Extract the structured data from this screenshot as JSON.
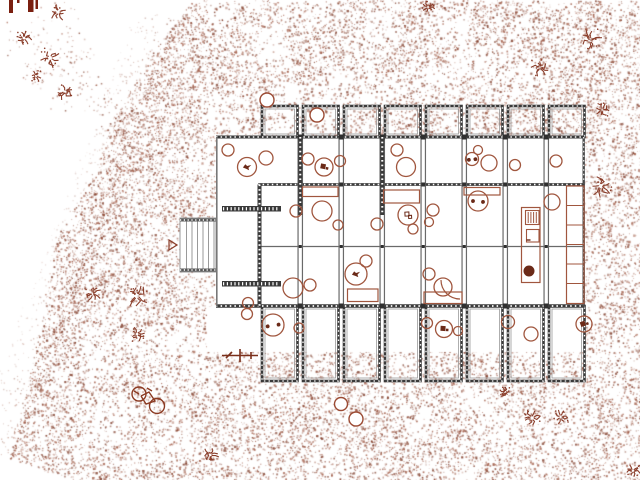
{
  "meta": {
    "width": 640,
    "height": 480,
    "kind": "architectural-site-plan"
  },
  "palette": {
    "paper": "#ffffff",
    "stipple_light": "#a05a45",
    "stipple_dark": "#7e3b28",
    "wall_dark": "#3a3a3a",
    "wall_mid": "#585858",
    "wall_light": "#9a9a9a",
    "furniture": "#a0563e",
    "furniture_dark": "#6b2a18",
    "maroon": "#7a1f10",
    "ground_symbol": "#8a3d2a"
  },
  "site": {
    "stipple_polygon": [
      [
        193,
        0
      ],
      [
        640,
        0
      ],
      [
        640,
        480
      ],
      [
        70,
        480
      ],
      [
        10,
        458
      ],
      [
        17,
        430
      ],
      [
        25,
        396
      ],
      [
        32,
        362
      ],
      [
        40,
        325
      ],
      [
        44,
        298
      ],
      [
        50,
        270
      ],
      [
        54,
        248
      ],
      [
        62,
        224
      ],
      [
        74,
        206
      ],
      [
        88,
        184
      ],
      [
        96,
        162
      ],
      [
        106,
        138
      ],
      [
        116,
        114
      ],
      [
        128,
        92
      ],
      [
        143,
        66
      ],
      [
        158,
        45
      ],
      [
        176,
        20
      ]
    ],
    "fade_band": {
      "from": [
        176,
        20
      ],
      "to": [
        10,
        458
      ],
      "width": 42,
      "dots": 700
    },
    "halo_trail": {
      "from": [
        70,
        40
      ],
      "to": [
        118,
        140
      ],
      "dots": 95
    },
    "fine_dots": 52000,
    "coarse_dots": 9000,
    "white_cutouts": [
      [
        216,
        137,
        368.5,
        169.5
      ],
      [
        207,
        306.5,
        377.5,
        45.5
      ],
      [
        180,
        218,
        36,
        54
      ]
    ]
  },
  "building": {
    "body": {
      "x0": 216,
      "y0": 137,
      "x1": 584.5,
      "y1": 306.5
    },
    "bay_lefts": [
      262,
      303,
      344,
      385,
      426,
      467,
      508,
      549
    ],
    "bay_width": 35.5,
    "top_bays": {
      "y0": 106,
      "y1": 137
    },
    "bottom_bays": {
      "y0": 306,
      "y1": 381
    },
    "columns": [
      300.25,
      341.25,
      382.25,
      423.25,
      464.25,
      505.25,
      546.25
    ],
    "mid_wall": {
      "y": 184.5,
      "x0": 258
    },
    "thin_line": {
      "y": 246.5,
      "x0": 258
    },
    "dark_walls": [
      [
        259.5,
        184.5,
        259.5,
        306.5
      ],
      [
        300.25,
        137,
        300.25,
        215
      ],
      [
        382.25,
        137,
        382.25,
        215
      ]
    ],
    "hatch_bars": [
      [
        222,
        206,
        59,
        5.5
      ],
      [
        222,
        281,
        59,
        5.5
      ]
    ]
  },
  "deck": {
    "x": 180,
    "y": 218,
    "w": 36,
    "h": 54,
    "planks": [
      186.5,
      192,
      197.5,
      203,
      208.5,
      214
    ]
  },
  "furniture": {
    "circles": [
      [
        228,
        150,
        6,
        ""
      ],
      [
        247,
        167,
        9.5,
        "bird"
      ],
      [
        266,
        158,
        7,
        ""
      ],
      [
        308,
        159,
        6,
        ""
      ],
      [
        324,
        167,
        9,
        "block"
      ],
      [
        340,
        161,
        5.5,
        ""
      ],
      [
        397,
        150,
        6,
        ""
      ],
      [
        406,
        167,
        9.5,
        ""
      ],
      [
        478,
        150,
        4.5,
        ""
      ],
      [
        472,
        159,
        6.5,
        "dots"
      ],
      [
        489,
        163,
        8,
        ""
      ],
      [
        515,
        165,
        5.5,
        ""
      ],
      [
        556,
        161,
        6,
        ""
      ],
      [
        296,
        211,
        6,
        ""
      ],
      [
        322,
        211,
        10,
        ""
      ],
      [
        338,
        225,
        5,
        ""
      ],
      [
        377,
        224,
        6,
        ""
      ],
      [
        408,
        215,
        10,
        "hinge"
      ],
      [
        413,
        229,
        5,
        ""
      ],
      [
        433,
        210,
        6,
        ""
      ],
      [
        429,
        222,
        4.5,
        ""
      ],
      [
        478,
        201,
        10,
        "dots"
      ],
      [
        552,
        202,
        8,
        ""
      ],
      [
        366,
        261,
        6,
        ""
      ],
      [
        356,
        274,
        11,
        "bird"
      ],
      [
        293,
        288,
        10,
        ""
      ],
      [
        310,
        285,
        6,
        ""
      ],
      [
        248,
        303,
        5.5,
        ""
      ],
      [
        429,
        274,
        6,
        ""
      ],
      [
        443,
        287,
        9,
        ""
      ],
      [
        247,
        314,
        5.5,
        ""
      ],
      [
        273,
        325,
        11,
        "dots"
      ],
      [
        299,
        328,
        5,
        ""
      ],
      [
        427,
        323,
        5.5,
        ""
      ],
      [
        444,
        329,
        8.5,
        "block"
      ],
      [
        458,
        331,
        4.5,
        ""
      ],
      [
        508,
        322,
        6.5,
        ""
      ],
      [
        531,
        334,
        7,
        ""
      ],
      [
        584,
        324,
        8,
        "block"
      ]
    ],
    "rects": [
      [
        302.5,
        187,
        35.5,
        9.5
      ],
      [
        383.5,
        190,
        36,
        13
      ],
      [
        464,
        187.5,
        36,
        7.5
      ],
      [
        347.5,
        289,
        30.5,
        12.5
      ],
      [
        424,
        292,
        38,
        11.5
      ]
    ],
    "kitchen": {
      "outer": [
        521.5,
        207.5,
        18.5,
        75
      ],
      "stove": [
        525.5,
        210.5,
        13.5,
        14
      ],
      "cabinet": [
        526.5,
        229.5,
        12.5,
        12.5
      ],
      "sink": [
        529,
        271,
        5
      ]
    },
    "shelf": {
      "rect": [
        566.5,
        186,
        17.5,
        117.5
      ],
      "dividers": [
        205.5,
        225,
        244.5,
        264,
        283.5
      ]
    },
    "door_arc": "M441,280 A19,19 0 0 0 460,299"
  },
  "landscape": {
    "trees": [
      [
        317,
        115,
        7
      ],
      [
        267,
        100,
        7
      ],
      [
        341,
        404,
        6.5
      ],
      [
        356,
        419,
        7
      ]
    ],
    "plants": [
      [
        58,
        12,
        10
      ],
      [
        24,
        38,
        8
      ],
      [
        50,
        58,
        11
      ],
      [
        65,
        92,
        9
      ],
      [
        36,
        76,
        6
      ],
      [
        93,
        294,
        9
      ],
      [
        137,
        296,
        13
      ],
      [
        137,
        334,
        8
      ],
      [
        210,
        455,
        9
      ],
      [
        428,
        7,
        7
      ],
      [
        590,
        40,
        12
      ],
      [
        540,
        68,
        9
      ],
      [
        602,
        110,
        8
      ],
      [
        601,
        186,
        12
      ],
      [
        505,
        392,
        6
      ],
      [
        532,
        418,
        10
      ],
      [
        561,
        417,
        9
      ],
      [
        633,
        471,
        8
      ]
    ],
    "bars": [
      [
        9,
        0,
        4,
        13
      ],
      [
        17,
        0,
        2.5,
        3
      ],
      [
        28,
        0,
        5.5,
        12
      ],
      [
        35.5,
        0,
        2.5,
        9
      ]
    ],
    "bicycle": {
      "wheels": [
        [
          139,
          394,
          7
        ],
        [
          157,
          406,
          7.5
        ]
      ],
      "frame": [
        [
          141,
          396
        ],
        [
          149,
          392
        ],
        [
          155,
          401
        ],
        [
          146,
          404
        ],
        [
          141,
          396
        ]
      ],
      "extras": [
        [
          147,
          388,
          152,
          391
        ],
        [
          134,
          391,
          139,
          394
        ]
      ]
    },
    "marker": {
      "lines": [
        [
          222,
          355.5,
          258,
          355.5
        ],
        [
          240,
          349,
          240,
          362
        ],
        [
          251,
          352,
          251,
          359
        ],
        [
          226,
          358,
          232,
          352
        ]
      ]
    },
    "triangle": [
      [
        169,
        240
      ],
      [
        169,
        250
      ],
      [
        177,
        245
      ]
    ]
  }
}
